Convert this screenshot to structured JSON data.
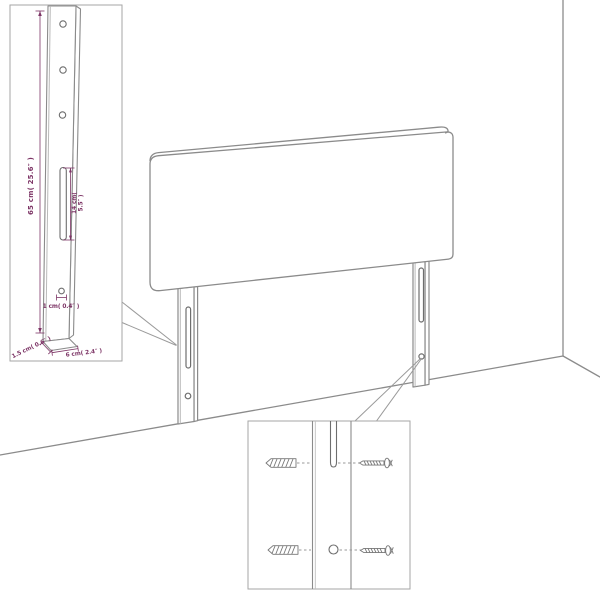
{
  "page": {
    "background": "#ffffff"
  },
  "palette": {
    "line_gray": "#8b8b8b",
    "detail_gray": "#6e6e6e",
    "box_border_gray": "#a6a6a6",
    "dimension_purple": "#7d3566"
  },
  "inset_leg_detail": {
    "description": "magnified headboard leg with dimensions",
    "hole_count": 3,
    "labels": {
      "leg_height": "65 cm( 25.6″ )",
      "slot_length_line1": "14 cm(",
      "slot_length_line2": "5.5″ )",
      "hole_diameter": "1 cm( 0.4″ )",
      "leg_depth": "1.5 cm( 0.6″ )",
      "leg_width": "6 cm( 2.4″ )"
    }
  },
  "headboard": {
    "description": "upholstered headboard panel standing in room corner",
    "leg_count": 2,
    "slots_per_leg": 1,
    "holes_per_leg": 1
  },
  "inset_mounting_detail": {
    "description": "wall mounting detail of leg with hardware",
    "wall_plug_count": 2,
    "screw_count": 2
  }
}
